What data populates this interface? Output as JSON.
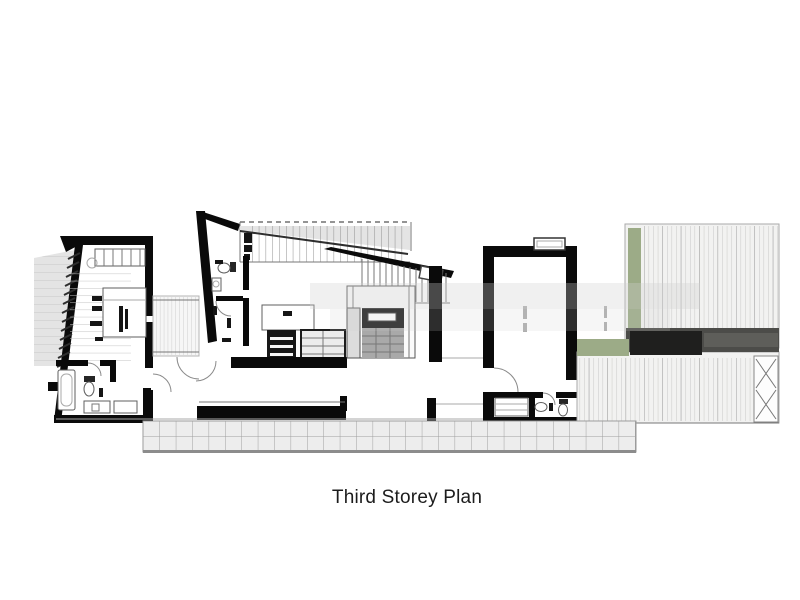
{
  "figure": {
    "caption": "Third Storey Plan"
  },
  "palette": {
    "wall": "#0a0a0a",
    "planter_green": "#9cab87",
    "deck_shadow": "#4c4c49",
    "fill_light": "#f2f2f1",
    "line_light": "#aaaaaa",
    "canopy_grid": "#ededed",
    "background": "#ffffff"
  },
  "drawing": {
    "kind": "architectural-floor-plan",
    "features": [
      "louvred-facade",
      "wardrobe",
      "bed",
      "bathtub",
      "toilet",
      "vanity",
      "link-bridge",
      "staircase",
      "shelving",
      "desk",
      "stair-core",
      "lift",
      "ensuite",
      "sink",
      "terrace-deck",
      "planter-strip",
      "pergola-shadow",
      "cross-brace-panel",
      "tiled-canopy"
    ]
  }
}
